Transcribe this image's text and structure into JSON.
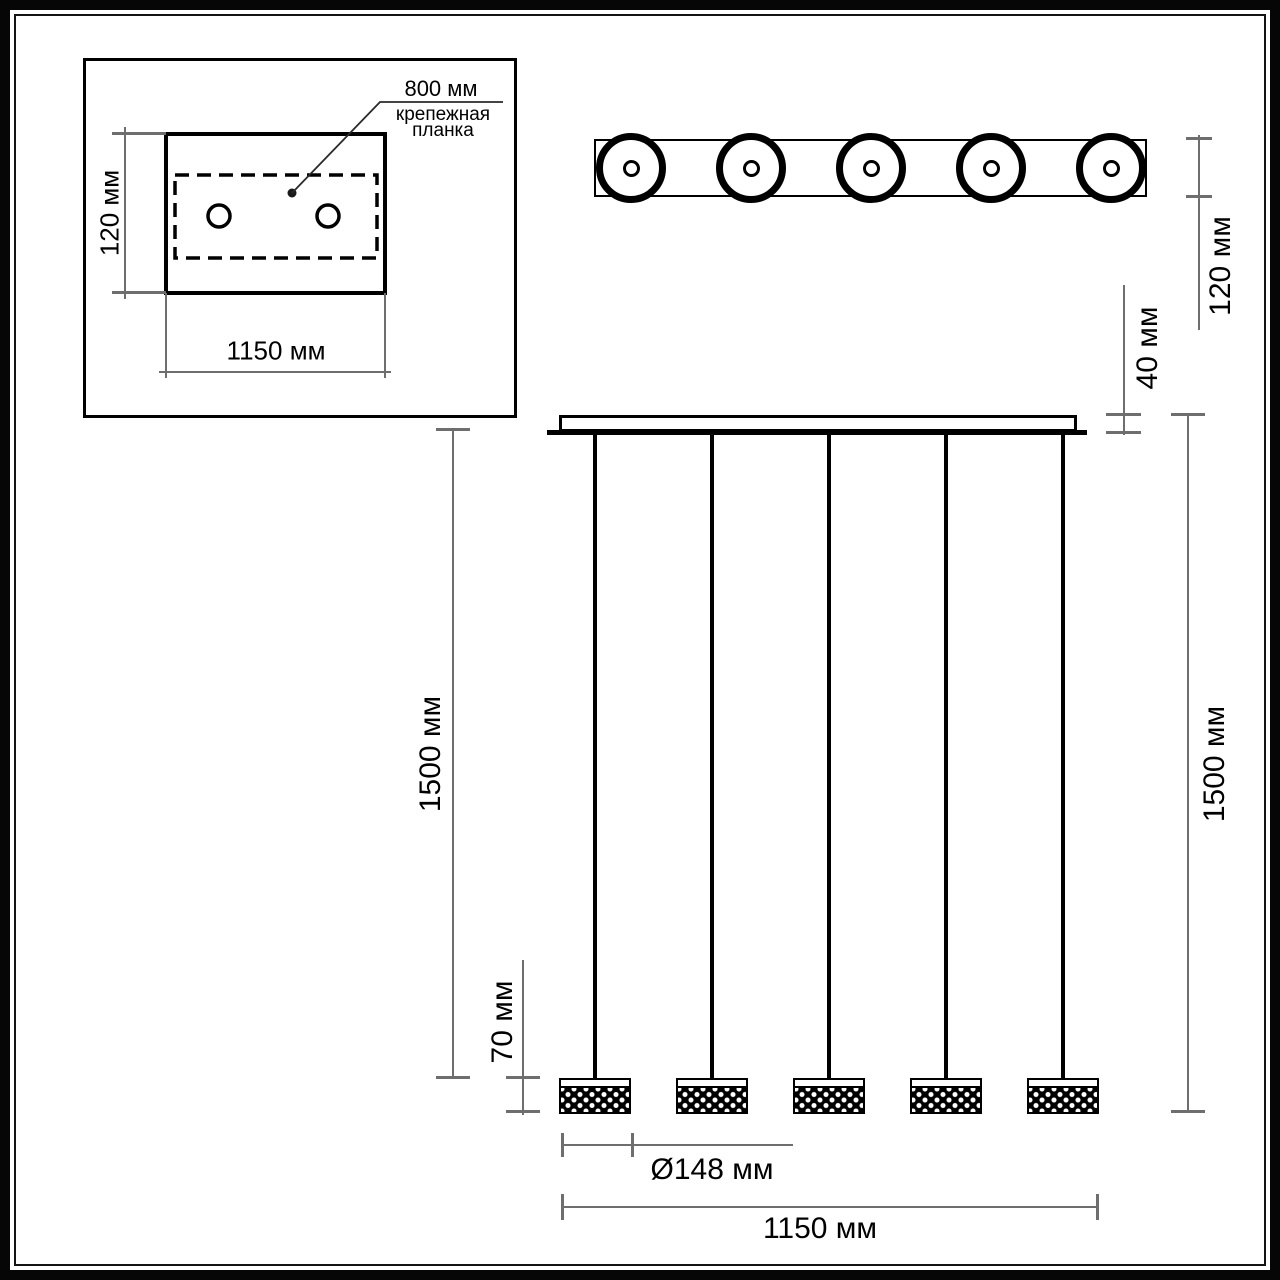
{
  "drawing": {
    "inset": {
      "dim_height": "120 мм",
      "dim_width": "1150 мм",
      "leader_value": "800 мм",
      "leader_caption_line1": "крепежная",
      "leader_caption_line2": "планка",
      "mounting_hole_count": 2
    },
    "top_view": {
      "dim_width": "120 мм",
      "lamp_count": 5
    },
    "elevation": {
      "dim_canopy_thickness": "40 мм",
      "dim_suspension_left": "1500 мм",
      "dim_suspension_right": "1500 мм",
      "dim_shade_height": "70 мм",
      "dim_shade_diameter": "Ø148 мм",
      "dim_overall_width": "1150 мм",
      "pendant_count": 5
    },
    "colors": {
      "line_black": "#000000",
      "dim_gray": "#6e6e6e",
      "background": "#ffffff"
    }
  }
}
